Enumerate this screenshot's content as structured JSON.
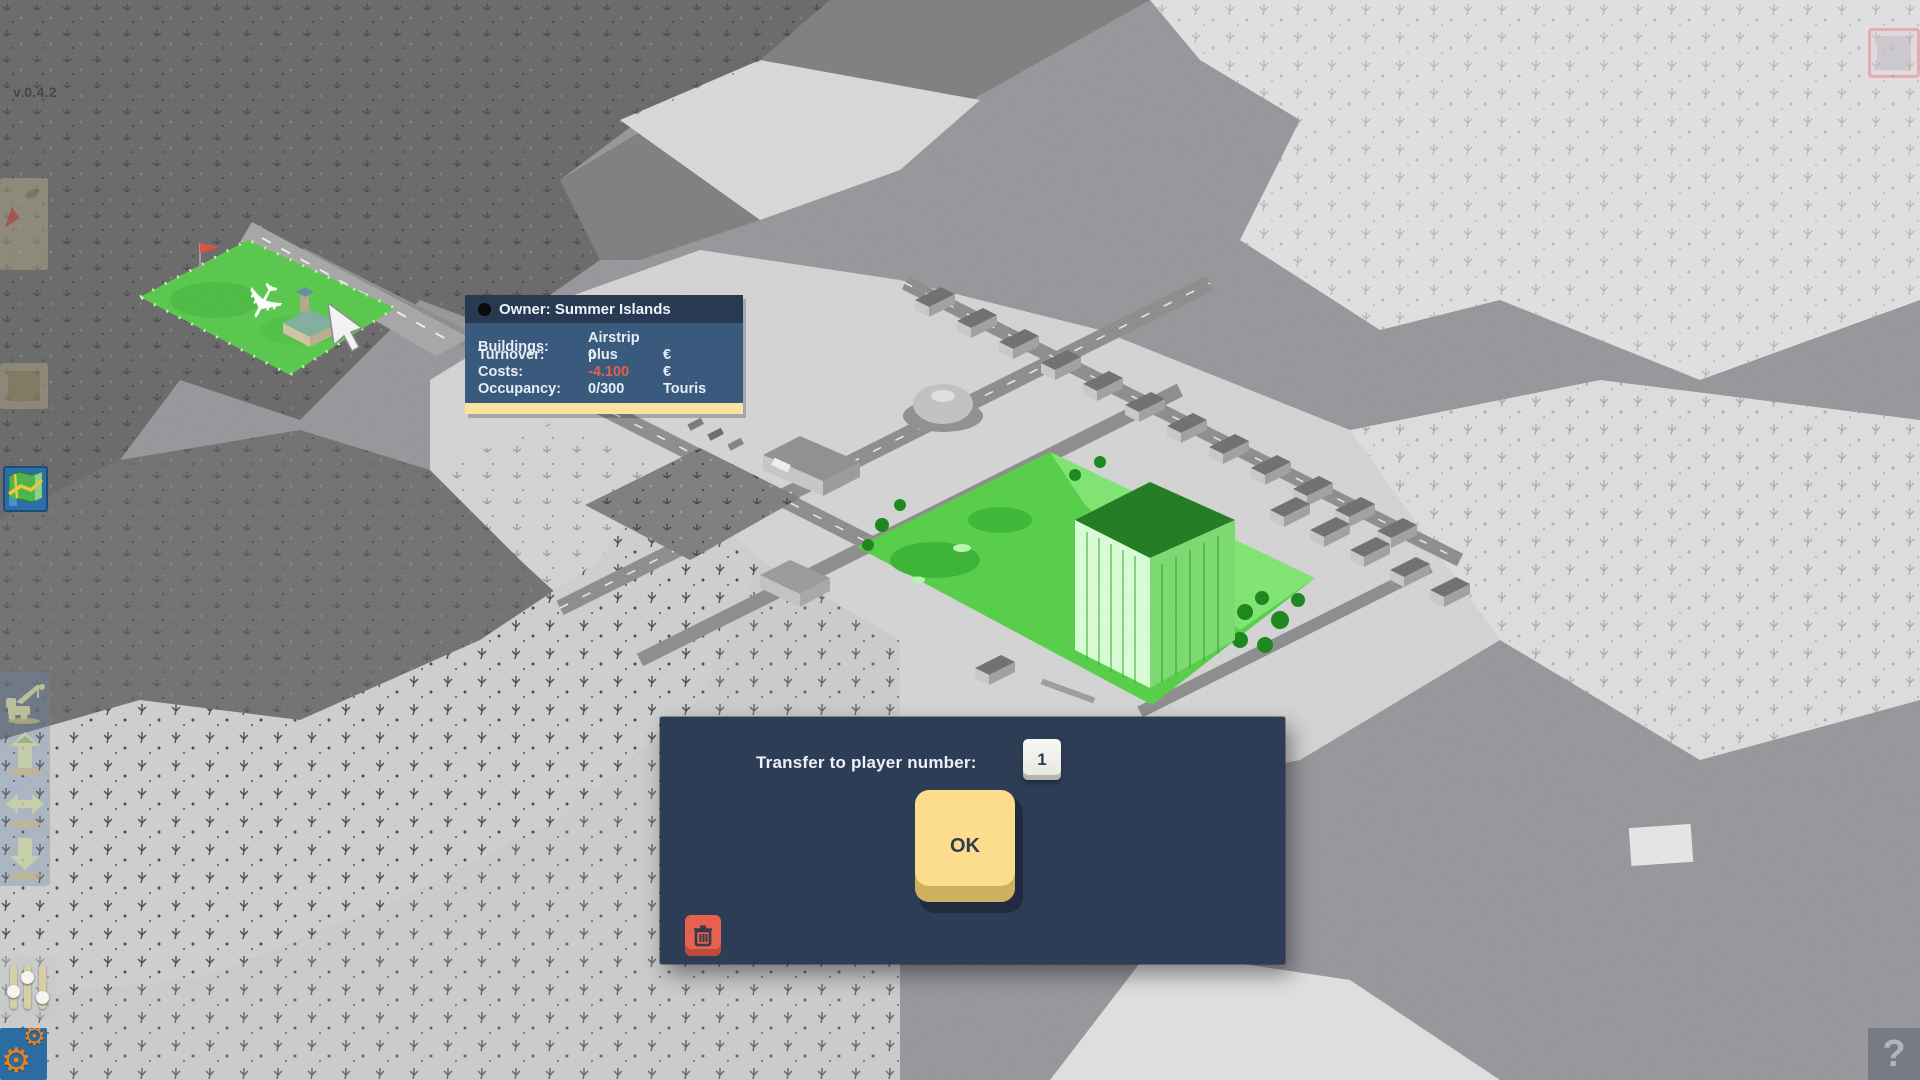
{
  "meta": {
    "version": "v.0.4.2"
  },
  "tooltip": {
    "owner": "Owner: Summer Islands",
    "rows": {
      "buildings": {
        "label": "Buildings:",
        "value": "Airstrip plus",
        "unit": ""
      },
      "turnover": {
        "label": "Turnover:",
        "value": "0",
        "unit": "€"
      },
      "costs": {
        "label": "Costs:",
        "value": "-4.100",
        "unit": "€"
      },
      "occupancy": {
        "label": "Occupancy:",
        "value": "0/300",
        "unit": "Touris"
      }
    }
  },
  "dialog": {
    "prompt": "Transfer to player number:",
    "player_number": "1",
    "ok_label": "OK"
  },
  "hud": {
    "help_label": "?",
    "icons": {
      "map": "map-icon",
      "crane": "crane-icon",
      "upgrade": "upgrade-arrow-icon",
      "transfer": "transfer-arrows-icon",
      "downgrade": "downgrade-arrow-icon",
      "sliders": "sliders-icon",
      "settings": "gear-icon",
      "trash": "trash-icon",
      "parrot": "parrot-icon",
      "cursor": "cursor-icon",
      "airplane": "airplane-icon"
    }
  },
  "colors": {
    "panel_navy": "#2e3d56",
    "tooltip_header": "#273a51",
    "tooltip_body": "#3a5a7d",
    "accent_bar": "#f8e3a0",
    "ok_yellow": "#fbdd8d",
    "danger_red": "#e8604f",
    "negative_text": "#e0604c",
    "highlight_green": "#53cf45"
  }
}
